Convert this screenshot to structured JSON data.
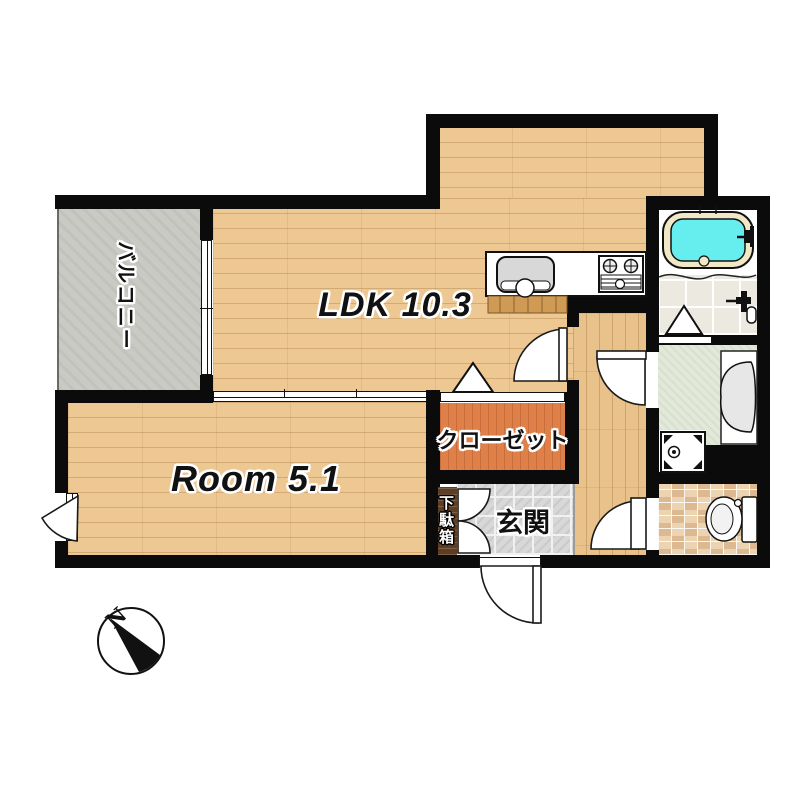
{
  "floor_plan": {
    "rooms": {
      "ldk": {
        "label": "LDK 10.3"
      },
      "bedroom": {
        "label": "Room 5.1"
      },
      "closet": {
        "label": "クローゼット"
      },
      "entrance": {
        "label": "玄関"
      },
      "shoe_cabinet": {
        "label": "下駄箱"
      },
      "balcony": {
        "label": "バルコニー"
      }
    },
    "compass": {
      "north_label": "N"
    },
    "fixtures": [
      "bathtub",
      "kitchen-sink",
      "gas-stove",
      "shower-fixture",
      "vanity-sink",
      "washing-machine-pan",
      "toilet",
      "entrance-door",
      "closet-folding-door",
      "bath-folding-door",
      "sliding-partition",
      "balcony-window"
    ],
    "colors": {
      "wall": "#0b0b0b",
      "wood_floor": "#edc893",
      "closet_floor": "#e08049",
      "balcony_floor": "#c9cac3",
      "entrance_tile": "#d8d8d8",
      "toilet_mosaic": "#ecd3b2",
      "washroom_floor": "#e3e9d8",
      "bath_tile": "#ebe9e0",
      "bathtub_water": "#66eded",
      "bathtub_rim": "#f1e8c6",
      "shoe_cabinet": "#5d3d24",
      "kitchen_cabinet": "#ce9a54"
    }
  }
}
